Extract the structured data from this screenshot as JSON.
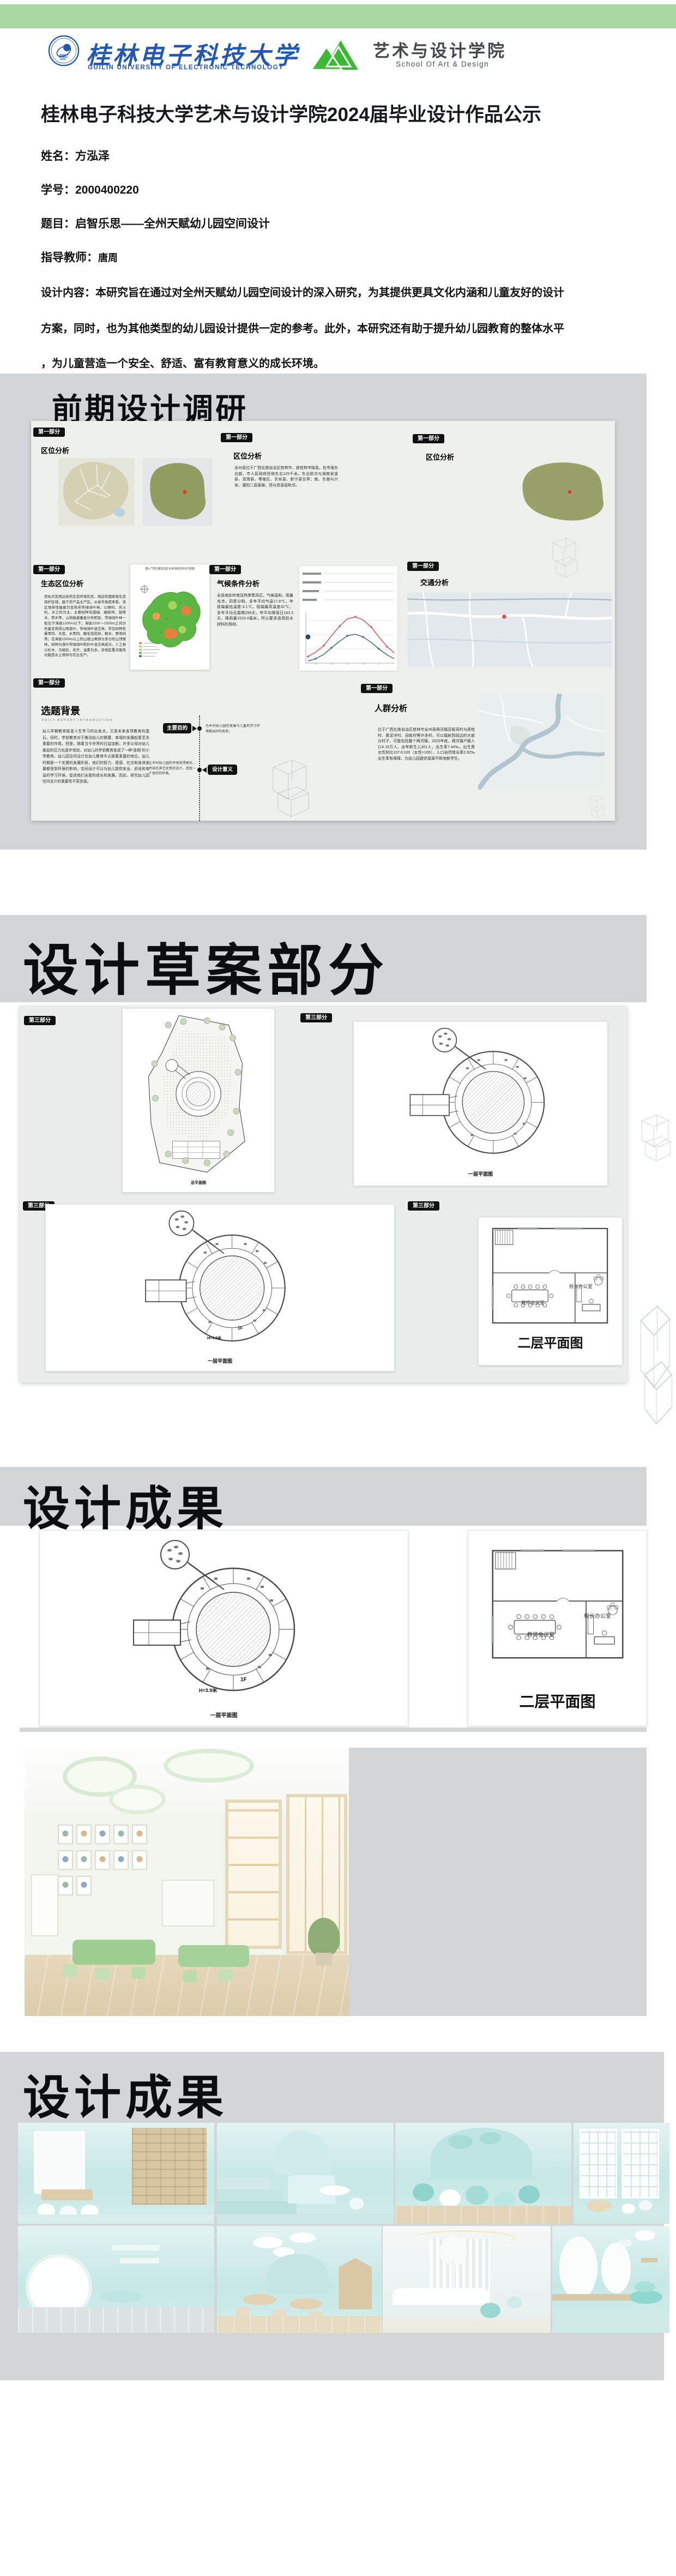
{
  "header": {
    "university": {
      "name": "桂林电子科技大学",
      "english": "GUILIN UNIVERSITY OF ELECTRONIC TECHNOLOGY"
    },
    "school": {
      "name": "艺术与设计学院",
      "english": "School Of Art & Design"
    }
  },
  "title": "桂林电子科技大学艺术与设计学院2024届毕业设计作品公示",
  "info": {
    "name_label": "姓名：",
    "name_value": "方泓泽",
    "id_label": "学号：",
    "id_value": "2000400220",
    "topic_label": "题目：",
    "topic_value": "启智乐思——全州天赋幼儿园空间设计",
    "advisor_label": "指导教师：",
    "advisor_value": "唐周",
    "content_label": "设计内容：",
    "content_lines": [
      "本研究旨在通过对全州天赋幼儿园空间设计的深入研究，为其提供更具文化内涵和儿童友好的设计",
      "方案，同时，也为其他类型的幼儿园设计提供一定的参考。此外，本研究还有助于提升幼儿园教育的整体水平",
      "，为儿童营造一个安全、舒适、富有教育意义的成长环境。"
    ]
  },
  "s1": {
    "heading": "前期设计调研",
    "part_tag": "第一部分",
    "loc1_title": "区位分析",
    "loc2_title": "区位分析",
    "loc2_text": "全州县位于广西壮族自治区桂林市，是桂林市辖县。在市境东北部，市人民政府驻地东北125千米。东北依次与湖南省道县、双牌县、零陵区、东安县、新宁县交界；南、东南与兴安、灌阳二县接壤；西与资源县毗邻。",
    "loc3_title": "区位分析",
    "eco_title": "生态区位分析",
    "eco_text": "目标点及周边自然生态环境优良，周边有国家级生态保护区域，属于农产品主产区。从省市角度来看，该区地带性植被为亚热带常绿阔叶林，以樟科、壳斗科、木兰科为主，主要树种有甜槠、细枝柯、银荷木、荷木等，山地植被垂直分布明显，常绿阔叶林一般位于海拔1200m以下；海拔1200～1500m之间分布着亚热带山地落叶、常绿阔叶混交林，常见树种有曼青冈、木莲、水青冈、腺毛泡花树、枫木、野漆树等；在海拔1500m以上的山坡山脊部分多分布山顶矮林，树种为落叶常绿阔叶和针叶混交林成分。人工林以杉木、马尾松、毛竹、油茶为多。该地区重点服务功能是水土保持与农业生产。",
    "map6_caption": "图6 广西壮族自治区主体功能区划分示意图",
    "climate_title": "气候条件分析",
    "climate_text": "全县地处岭南亚热带季风区，气候温和，雨量充沛，四季分明，多年平均气温17.8℃，年极端最低温度-3.1℃，极端最高温度42℃，多年平均无霜期299天，年平均降雨日163.3天，降雨量1519.4毫米，所以要多选用防水材料的用材。",
    "traffic_title": "交通分析",
    "bg_title": "选题背景",
    "bg_subtitle": "DAILY REPORT INTRODUCTION",
    "bg_text": "幼儿早期教育既是人生学习的出发点，又是未来各项教育的基石。同时，学前教育对于推动幼儿的健康、幸福的发展起着至关重要的作用。但是，随着当今世界的日益加剧，许多父母对幼儿施加的压力也逐步增加，对幼儿的学前教育变成了一种“变相”的小学教育。幼儿园空间设计在幼儿教育中占据着重要的地位。幼儿时期是一个关键的发展阶段，他们的智力、情感、社交和身体发展都受到环境的影响。空间设计可以为幼儿提供安全、舒适和有益的学习环境，促进他们全面的成长和发展。因此，研究幼儿园空间设计的重要性不容忽视。",
    "purpose_label": "主要目的",
    "purpose_note": "为乡村幼儿园的发展与儿童的学习环境做出好的改变。",
    "meaning_label": "设计意义",
    "meaning_note": "让乡村幼儿园的环境变得更好，并结合其它优秀的设计，造就一个良好的环境。",
    "people_title": "人群分析",
    "people_text": "位于广西壮族自治区桂林市全州县两河镇百板洞村与厚桂村、黄泥冲村、田乾村等许多村，可以辐射到周边的大部分村子，可能包括整个两河镇。2020年底，两河镇户籍人口4.19万人。全年新生儿301人，出生率7.44‰，出生男女性别比107.6∶100（女性=100），人口自然增长率2.82‰出生率有保障，为幼儿园提供源源不断地新学生。"
  },
  "s2": {
    "heading": "设计草案部分",
    "part_tag": "第三部分"
  },
  "plans": {
    "site": "总平面图",
    "f1": "一层平面图",
    "f2": "二层平面图",
    "meeting": "教师会议室",
    "office": "校长办公室",
    "f1_mark": "1F",
    "h_mark": "H=3.9米"
  },
  "s3": {
    "heading": "设计成果"
  },
  "s4": {
    "heading": "设计成果"
  },
  "colors": {
    "brand_blue": "#2358ae",
    "brand_green": "#3bb935",
    "bar_green": "#a9d7a2",
    "section_gray": "#d2d6d9",
    "mint": "#c6e8e5"
  }
}
